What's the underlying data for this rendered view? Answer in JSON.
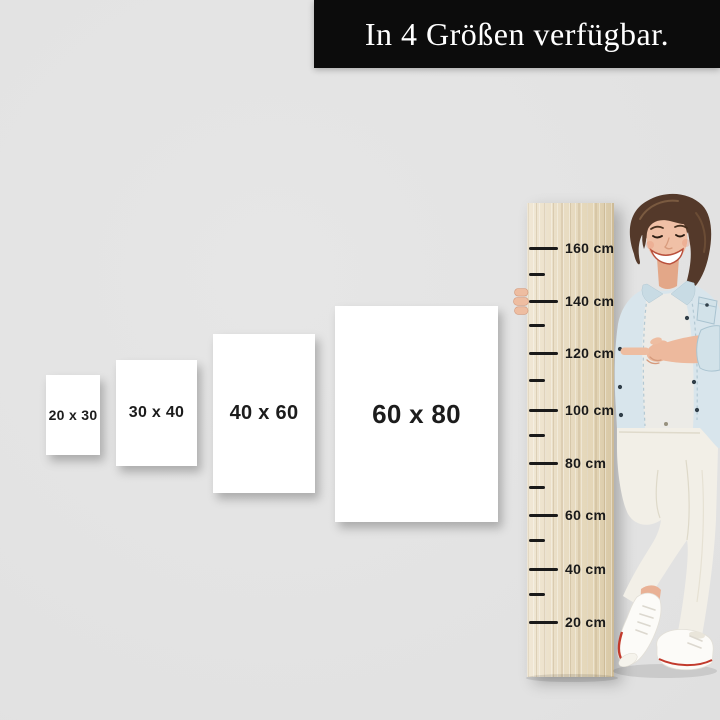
{
  "banner": {
    "text": "In 4 Größen verfügbar.",
    "background": "#0c0c0c",
    "text_color": "#ffffff"
  },
  "posters": {
    "items": [
      {
        "label": "20 x 30"
      },
      {
        "label": "30 x 40"
      },
      {
        "label": "40 x 60"
      },
      {
        "label": "60 x 80"
      }
    ]
  },
  "ruler": {
    "labels": [
      "160 cm",
      "140 cm",
      "120 cm",
      "100 cm",
      "80 cm",
      "60 cm",
      "40 cm",
      "20 cm"
    ],
    "tick_color": "#1a1a1a",
    "wood_color": "#e8dcc4"
  },
  "photo": {
    "subject": "smiling woman holding measuring board and pointing at the 120 cm mark"
  },
  "background_color": "#e2e2e2"
}
